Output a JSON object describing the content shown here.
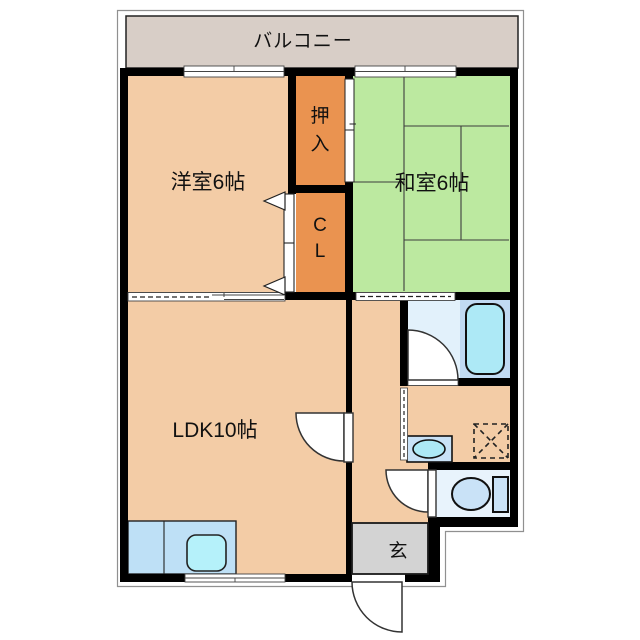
{
  "plan_type": "apartment-floor-plan",
  "balcony": {
    "label": "バルコニー"
  },
  "rooms": {
    "western_room": {
      "label": "洋室6帖"
    },
    "japanese_room": {
      "label": "和室6帖"
    },
    "ldk": {
      "label": "LDK10帖"
    },
    "oshiire": {
      "char1": "押",
      "char2": "入"
    },
    "closet": {
      "char1": "C",
      "char2": "L"
    },
    "entrance": {
      "label": "玄"
    }
  },
  "fixtures": [
    "kitchen-counter",
    "kitchen-sink",
    "bathtub",
    "bathroom",
    "washbasin",
    "washing-machine-space",
    "toilet",
    "entrance-door",
    "room-doors",
    "sliding-windows",
    "tatami-mats"
  ],
  "colors": {
    "room_peach": "#F3CCA6",
    "closet_orange": "#EA9350",
    "tatami_green": "#BCE9A0",
    "balcony_beige": "#D8CEC7",
    "entrance_gray": "#D3D3D3",
    "bath_floor": "#E2F1FB",
    "tub_zone": "#C1DAF2",
    "fixture_cyan": "#ADE9F6",
    "fixture_blue": "#C9E2F7",
    "counter_blue": "#BEE0F6",
    "sink_cyan": "#B5F1FA",
    "wall_black": "#000000",
    "toilet_floor": "#E8F3FC"
  }
}
